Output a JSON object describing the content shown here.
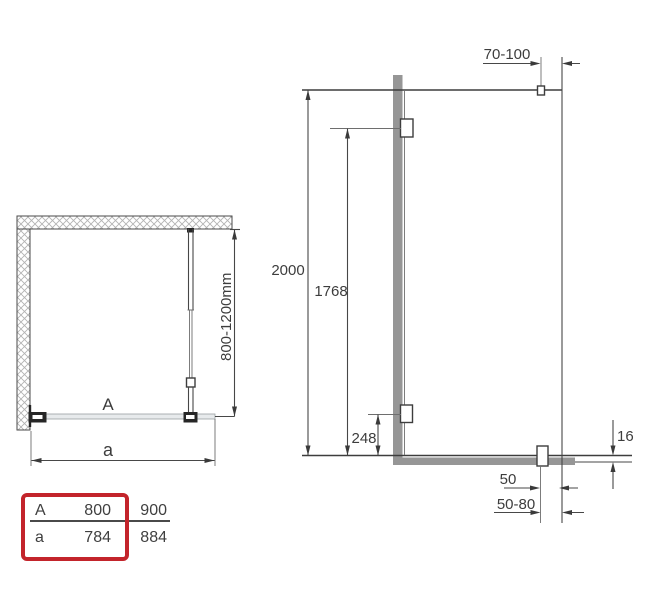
{
  "plan_view": {
    "glass_label": "A",
    "width_dim_label": "a",
    "support_bar_range": "800-1200mm"
  },
  "elevation_view": {
    "total_height": "2000",
    "upper_bracket_height": "1768",
    "lower_bracket_height": "248",
    "top_mount_range": "70-100",
    "bottom_profile_height": "16",
    "foot_offset": "50",
    "foot_offset_range": "50-80"
  },
  "size_table": {
    "rows": [
      {
        "label": "A",
        "values": [
          "800",
          "900"
        ]
      },
      {
        "label": "a",
        "values": [
          "784",
          "884"
        ]
      }
    ],
    "highlighted_size": "800"
  },
  "colors": {
    "accent_red": "#c3242b",
    "profile_gray": "#969696",
    "line_dark": "#3d3d3d",
    "glass_fill": "#e7eaec"
  }
}
